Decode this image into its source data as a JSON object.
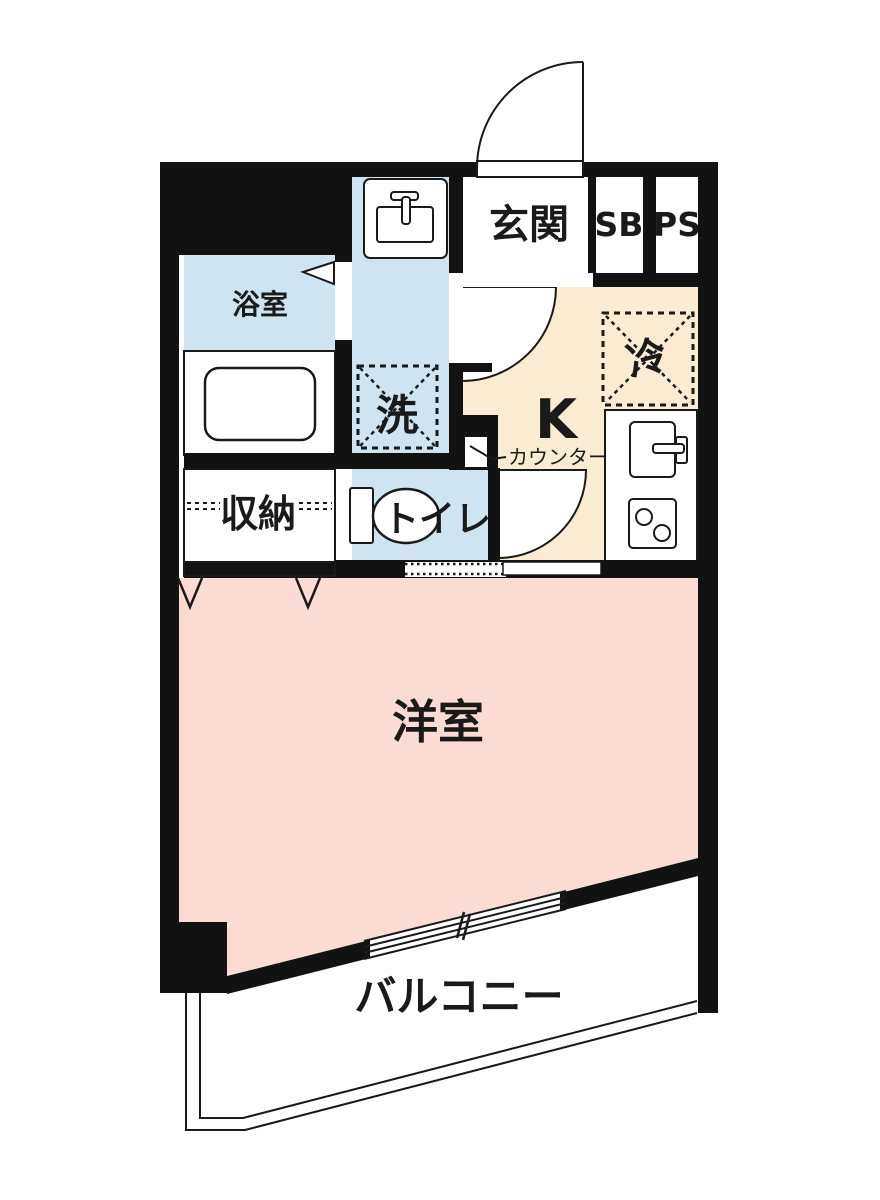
{
  "plan": {
    "type": "apartment-floor-plan",
    "labels": {
      "entrance": "玄関",
      "shoe_box": "SB",
      "pipe_space": "PS",
      "bathroom": "浴室",
      "washer": "洗",
      "storage": "収納",
      "toilet": "トイレ",
      "kitchen": "K",
      "counter": "カウンター",
      "fridge": "冷",
      "western_room": "洋室",
      "balcony": "バルコニー"
    },
    "colors": {
      "wall": "#121212",
      "wet_area_floor": "#cfe3f1",
      "kitchen_floor": "#faecd2",
      "room_floor": "#fadcd5",
      "paper": "#ffffff"
    }
  }
}
